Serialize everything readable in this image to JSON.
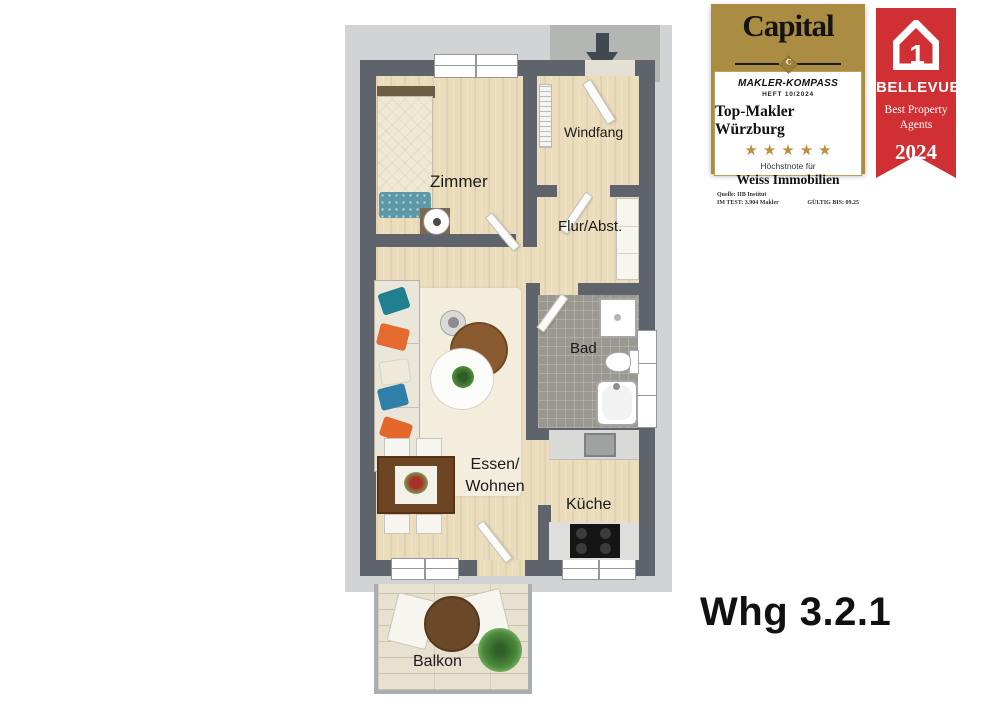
{
  "floorplan": {
    "rooms": {
      "zimmer": "Zimmer",
      "windfang": "Windfang",
      "flur": "Flur/Abst.",
      "bad": "Bad",
      "essen_line1": "Essen/",
      "essen_line2": "Wohnen",
      "kueche": "Küche",
      "balkon": "Balkon"
    },
    "colors": {
      "wall": "#5f636b",
      "wood_floor": "#ebdcbc",
      "surround": "#d2d3d5",
      "entry_pad": "#b4b6b4",
      "bath_tiles": "#9b9891",
      "balcony_deck": "#e9e1cf"
    }
  },
  "unit_label": "Whg 3.2.1",
  "badges": {
    "capital": {
      "brand": "Capital",
      "emblem_letter": "C",
      "series": "MAKLER-KOMPASS",
      "issue": "HEFT 10/2024",
      "title": "Top-Makler Würzburg",
      "stars": "★★★★★",
      "note": "Höchstnote für",
      "company": "Weiss Immobilien",
      "source_line1": "Quelle: IIB Institut",
      "source_line2": "IM TEST: 3.904 Makler",
      "valid_until": "GÜLTIG BIS: 09.25",
      "gold": "#aa8c42"
    },
    "bellevue": {
      "brand": "BELLEVUE",
      "award_line1": "Best Property",
      "award_line2": "Agents",
      "year": "2024",
      "red": "#d02f33"
    }
  }
}
